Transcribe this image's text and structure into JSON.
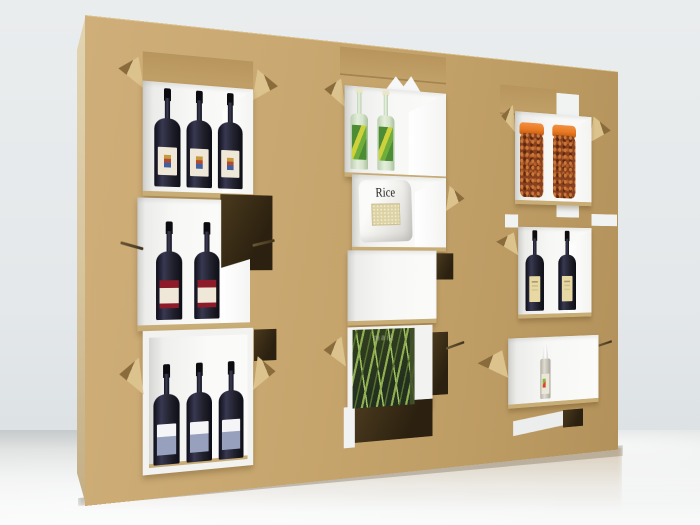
{
  "scene": {
    "description": "3D render of a freestanding tan cardboard retail display wall with cut-out white shelf boxes and fold-out flaps, standing on a reflective grey floor",
    "environment": {
      "wall": "light grey studio wall",
      "floor": "glossy light grey floor"
    }
  },
  "display": {
    "material": "cardboard",
    "columns": [
      {
        "id": "left",
        "cells": [
          {
            "type": "shelf-box",
            "product": "red-wine-bottle-white-label",
            "count": 3
          },
          {
            "type": "shelf-box",
            "product": "red-wine-bottle-red-band-label",
            "count": 2
          },
          {
            "type": "shelf-box",
            "product": "red-wine-bottle-blue-label",
            "count": 3
          }
        ]
      },
      {
        "id": "middle",
        "cells": [
          {
            "type": "shelf-box",
            "product": "green-glass-bottle",
            "count": 2
          },
          {
            "type": "shelf-box",
            "product": "rice-bag",
            "count": 1,
            "label": "Rice"
          },
          {
            "type": "shelf-box",
            "product": "empty",
            "count": 0
          },
          {
            "type": "shelf-box",
            "product": "grass-cereal-box",
            "count": 1,
            "label": "maiz"
          },
          {
            "type": "open-cutout",
            "product": "none",
            "count": 0
          }
        ]
      },
      {
        "id": "right",
        "cells": [
          {
            "type": "shelf-box",
            "product": "spice-jar-orange-lid",
            "count": 2
          },
          {
            "type": "shelf-box",
            "product": "dark-wine-bottle-gold-label",
            "count": 2
          },
          {
            "type": "shelf-box",
            "product": "oil-spray-bottle",
            "count": 1
          },
          {
            "type": "open-cutout",
            "product": "none",
            "count": 0
          }
        ]
      }
    ]
  },
  "colors": {
    "tan": "#c6a56d",
    "tan-light": "#cfae79",
    "tan-dark": "#b3915a",
    "side": "#d6c49c",
    "flap-light": "#dcc28c",
    "flap-dark": "#8a6c3c",
    "hole": "#2c2110",
    "box-white": "#f7f7f5",
    "lip": "#c9ad76",
    "wall": "#eaedee",
    "floor": "#eff0f0",
    "wine-glass": "#23232f",
    "wine-cap": "#0b0b10",
    "label-cream": "#efe8d8",
    "label-red": "#8e1b2a",
    "label-blue": "#97a0bd",
    "label-gold": "#e8d8a4",
    "green-bottle": "#d5e3ca",
    "green-label": "#4c8c34",
    "spice": "#8a3f1e",
    "spice-cap": "#e87a22",
    "grass-dark": "#24301f",
    "grass-blade": "#8fb050",
    "spray-body": "#dfdcd2",
    "reflection-tan": "rgba(173,143,94,0.42)"
  }
}
